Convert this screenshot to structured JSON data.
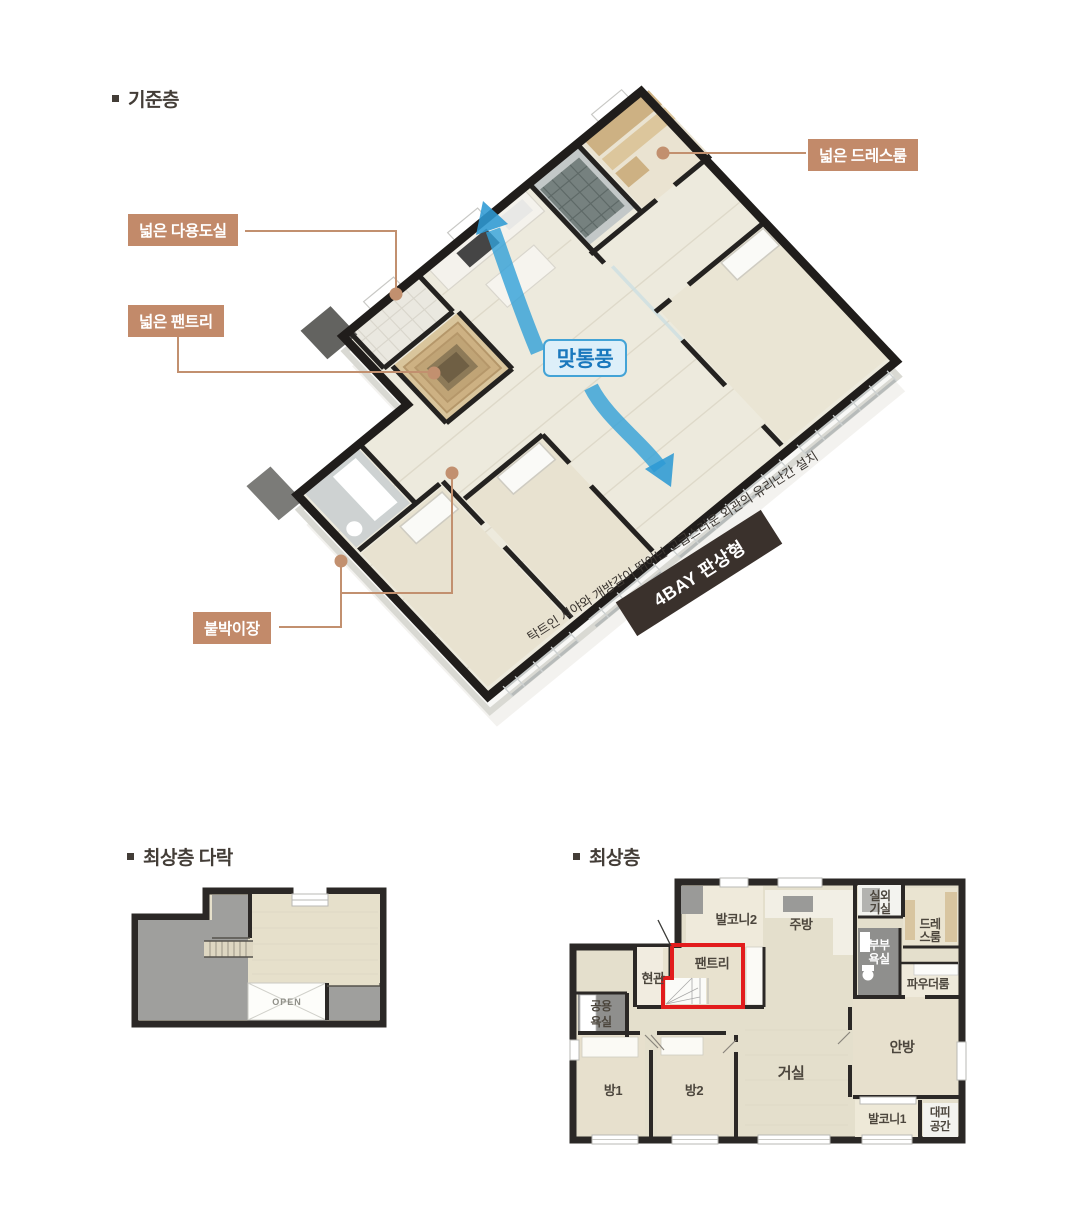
{
  "sections": {
    "standard_floor": {
      "title": "기준층",
      "callouts": {
        "utility": "넓은 다용도실",
        "pantry": "넓은 팬트리",
        "dressroom": "넓은 드레스룸",
        "closet": "붙박이장"
      },
      "ventilation_badge": "맞통풍",
      "diagonal_caption": "탁트인 시야와 개방감이 뛰어난 고급스러운 외관의 유리난간 설치",
      "bay_badge": "4BAY 판상형"
    },
    "attic": {
      "title": "최상층 다락",
      "open_label": "OPEN"
    },
    "top_floor": {
      "title": "최상층",
      "rooms": {
        "balcony2": "발코니2",
        "kitchen": "주방",
        "outdoor_unit_line1": "실외",
        "outdoor_unit_line2": "기실",
        "dressroom_line1": "드레",
        "dressroom_line2": "스룸",
        "master_bath_line1": "부부",
        "master_bath_line2": "욕실",
        "powder_room": "파우더룸",
        "entrance": "현관",
        "pantry": "팬트리",
        "shared_bath_line1": "공용",
        "shared_bath_line2": "욕실",
        "bedroom1": "방1",
        "bedroom2": "방2",
        "living_room": "거실",
        "master_bedroom": "안방",
        "balcony1": "발코니1",
        "shelter_line1": "대피",
        "shelter_line2": "공간"
      }
    }
  },
  "colors": {
    "callout_bg": "#c28a6a",
    "ventilation_border": "#43a3d6",
    "ventilation_text": "#1a78bd",
    "bay_badge_bg": "#3a312c",
    "highlight_red": "#e21c1d",
    "arrow_blue": "#31a0d8",
    "wall_dark": "#2b2826",
    "floor_cream": "#edeadd"
  }
}
